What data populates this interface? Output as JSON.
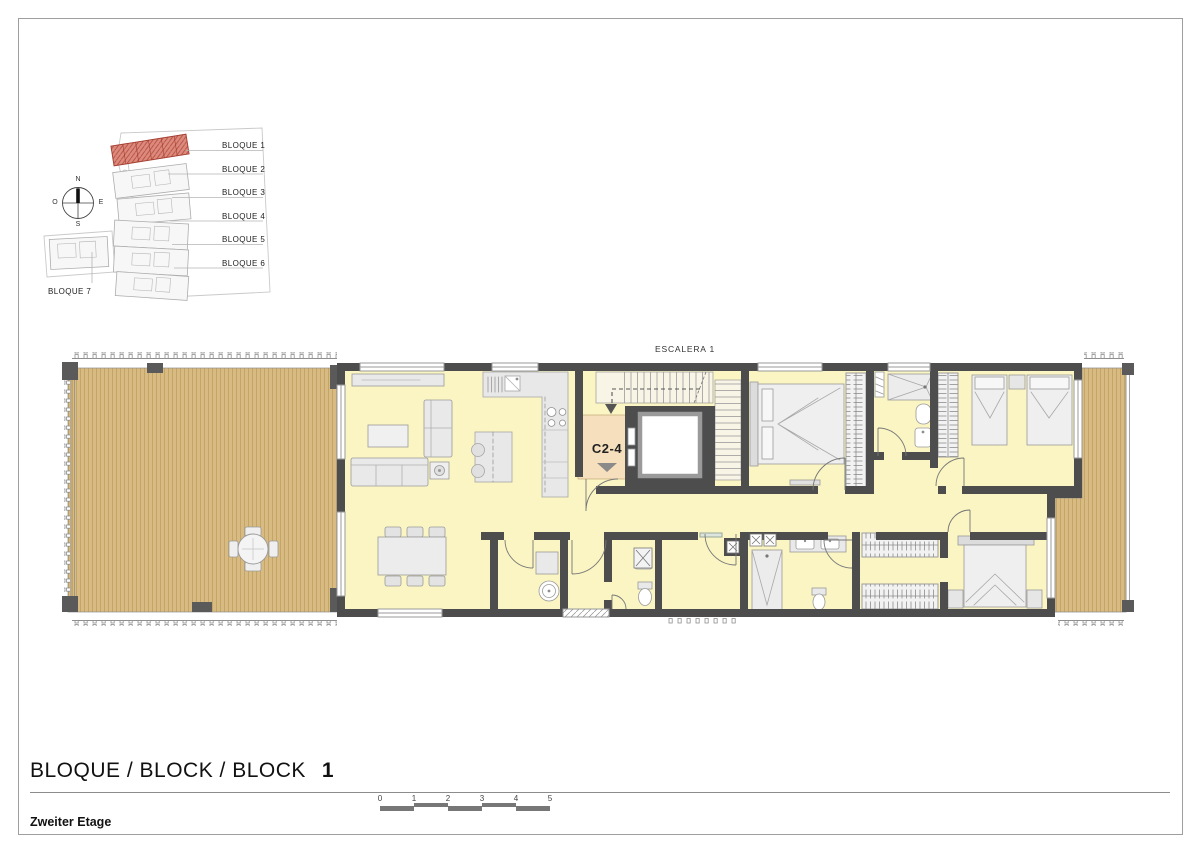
{
  "sheet": {
    "title_block": {
      "title": "BLOQUE / BLOCK / BLOCK",
      "block_number": "1",
      "floor_label": "Zweiter Etage"
    }
  },
  "keymap": {
    "highlighted_block": "BLOQUE 1",
    "blocks": [
      {
        "label": "BLOQUE 1"
      },
      {
        "label": "BLOQUE 2"
      },
      {
        "label": "BLOQUE 3"
      },
      {
        "label": "BLOQUE 4"
      },
      {
        "label": "BLOQUE 5"
      },
      {
        "label": "BLOQUE 6"
      },
      {
        "label": "BLOQUE 7"
      }
    ]
  },
  "compass": {
    "north": "N",
    "east": "E",
    "south": "S",
    "west": "O"
  },
  "plan": {
    "stair_label": "ESCALERA 1",
    "unit_label": "C2-4"
  },
  "scalebar": {
    "ticks": [
      "0",
      "1",
      "2",
      "3",
      "4",
      "5"
    ]
  },
  "colors": {
    "wall": "#4d4d4d",
    "floor": "#faf5c3",
    "wood": "#d8bb82",
    "entry": "#f6dfbc",
    "highlight_red": "#dd8a7c",
    "frame": "#9e9e9e"
  }
}
